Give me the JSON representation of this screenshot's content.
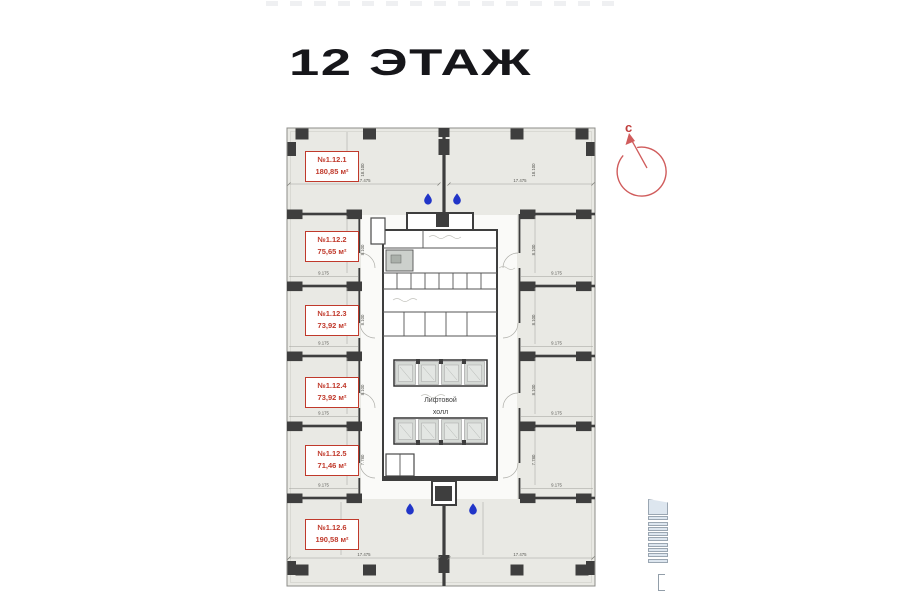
{
  "title": "12 ЭТАЖ",
  "compass": {
    "north_label": "с"
  },
  "plan": {
    "rooms": [
      {
        "number": "№1.12.1",
        "area": "180,85 м²"
      },
      {
        "number": "№1.12.2",
        "area": "75,65 м²"
      },
      {
        "number": "№1.12.3",
        "area": "73,92 м²"
      },
      {
        "number": "№1.12.4",
        "area": "73,92 м²"
      },
      {
        "number": "№1.12.5",
        "area": "71,46 м²"
      },
      {
        "number": "№1.12.6",
        "area": "190,58 м²"
      }
    ],
    "elevator_hall": {
      "line1": "Лифтовой",
      "line2": "холл"
    },
    "dimensions": {
      "width_half": "17.475",
      "room_width": "9.175",
      "room_depth": "8.100",
      "room_depth_small": "7.780",
      "band_depth": "18.100"
    },
    "colors": {
      "floor": "#e9e9e4",
      "wall": "#3e3e3e",
      "label_red": "#c0392b",
      "compass_red": "#d05c5c",
      "drop_blue": "#2135c8",
      "bars_blue": "#dde6ef"
    }
  }
}
